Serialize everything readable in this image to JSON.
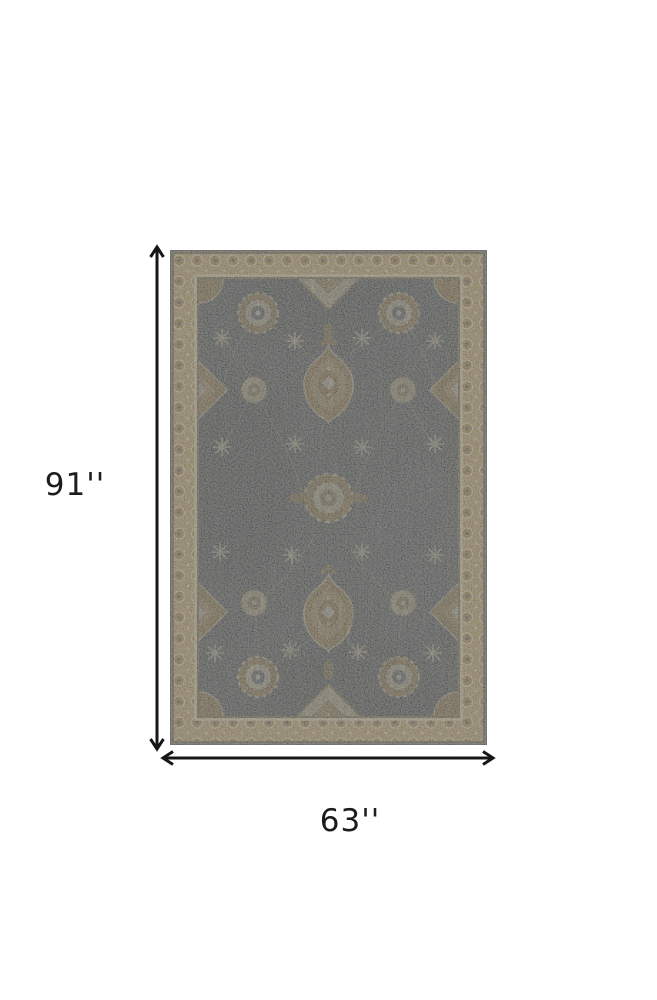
{
  "page": {
    "background": "#ffffff"
  },
  "diagram": {
    "subject": "area rug dimension view",
    "height": {
      "label": "91''",
      "inches": 91
    },
    "width": {
      "label": "63''",
      "inches": 63
    },
    "arrow_color": "#161616",
    "label_color": "#1c1c1c"
  },
  "rug": {
    "colors": {
      "field": "#5f6770",
      "field_shadow": "#41464e",
      "border_band": "#c3a877",
      "gold": "#b28d58",
      "cream": "#ddd3b5",
      "brown": "#8a6b43",
      "edge": "#8d8d85"
    }
  }
}
